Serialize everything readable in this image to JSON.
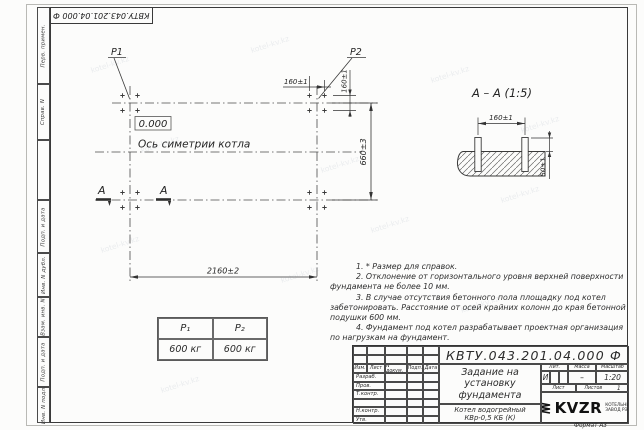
{
  "sheet": {
    "stamp_top": "КВТУ.043.201.04.000  Ф",
    "format_note": "Формат А3",
    "watermark": "kotel-kv.kz"
  },
  "margin_column": {
    "perv_primen": "Перв. примен.",
    "sprav_n": "Справ. N",
    "podp_i_data_1": "Подп. и дата",
    "inv_n_dubl": "Инв. N дубл.",
    "vzam_inv_n": "Взам. инв. N",
    "podp_i_data_2": "Подп. и дата",
    "inv_n_podl": "Инв. N подл."
  },
  "plan": {
    "p1": "P1",
    "p2": "P2",
    "level": "0.000",
    "axis": "Ось симетрии котла",
    "section_a_left": "А",
    "section_a_right": "А",
    "dim_width": "2160±2",
    "dim_height": "660±3",
    "dim_bolt_x": "160±1",
    "dim_bolt_y": "160±1"
  },
  "section": {
    "title": "А – А (1:5)",
    "dim_spacing": "160±1",
    "dim_height": "50±1"
  },
  "loads": {
    "p1_header": "P₁",
    "p2_header": "P₂",
    "p1_value": "600 кг",
    "p2_value": "600 кг"
  },
  "notes": {
    "n1": "1. * Размер для справок.",
    "n2": "2. Отклонение от горизонтального уровня верхней поверхности фундамента не более 10 мм.",
    "n3": "3. В случае отсутствия бетонного пола площадку под котел забетонировать. Расстояние от осей крайних колонн до края бетонной подушки 600 мм.",
    "n4": "4. Фундамент под котел разрабатывает проектная организация по нагрузкам на фундамент."
  },
  "title_block": {
    "doc_number": "КВТУ.043.201.04.000 Ф",
    "title": "Задание на установку фундамента",
    "product": "Котел водогрейный КВр-0,5 КБ (К)",
    "col_izm": "Изм.",
    "col_list": "Лист",
    "col_ndoc": "N докум.",
    "col_podp": "Подп.",
    "col_data": "Дата",
    "row_razrab": "Разраб.",
    "row_prov": "Пров.",
    "row_tkontr": "Т.контр.",
    "row_nkontr": "Н.контр.",
    "row_utv": "Утв.",
    "lit_label": "Лит.",
    "mass_label": "Масса",
    "scale_label": "Масштаб",
    "lit_value": "И",
    "mass_value": "–",
    "scale_value": "1:20",
    "sheet_label": "Лист",
    "sheets_label": "Листов",
    "sheets_value": "1",
    "company_name": "KVZR",
    "company_line1": "КОТЕЛЬНЫЙ",
    "company_line2": "ЗАВОД РЭП"
  }
}
